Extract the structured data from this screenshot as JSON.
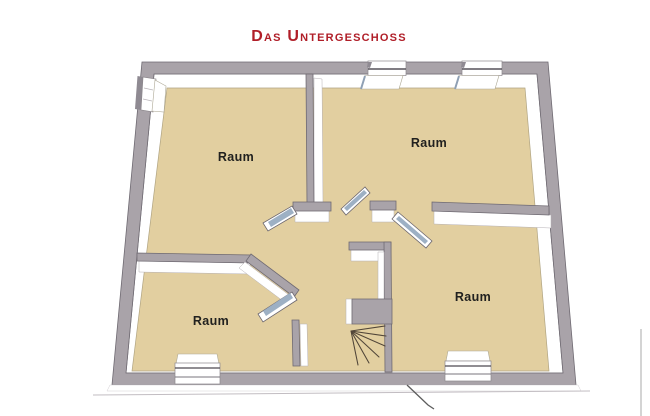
{
  "title": "Das Untergeschoss",
  "rooms": [
    {
      "id": "room-top-left",
      "label": "Raum"
    },
    {
      "id": "room-top-right",
      "label": "Raum"
    },
    {
      "id": "room-bottom-left",
      "label": "Raum"
    },
    {
      "id": "room-bottom-right",
      "label": "Raum"
    }
  ],
  "colors": {
    "title": "#b01e28",
    "floor": "#e2cfa0",
    "wall_top": "#a9a3a9",
    "wall_face": "#ffffff",
    "door_glass": "#9db0c4",
    "label_text": "#21211f",
    "background": "#ffffff"
  }
}
